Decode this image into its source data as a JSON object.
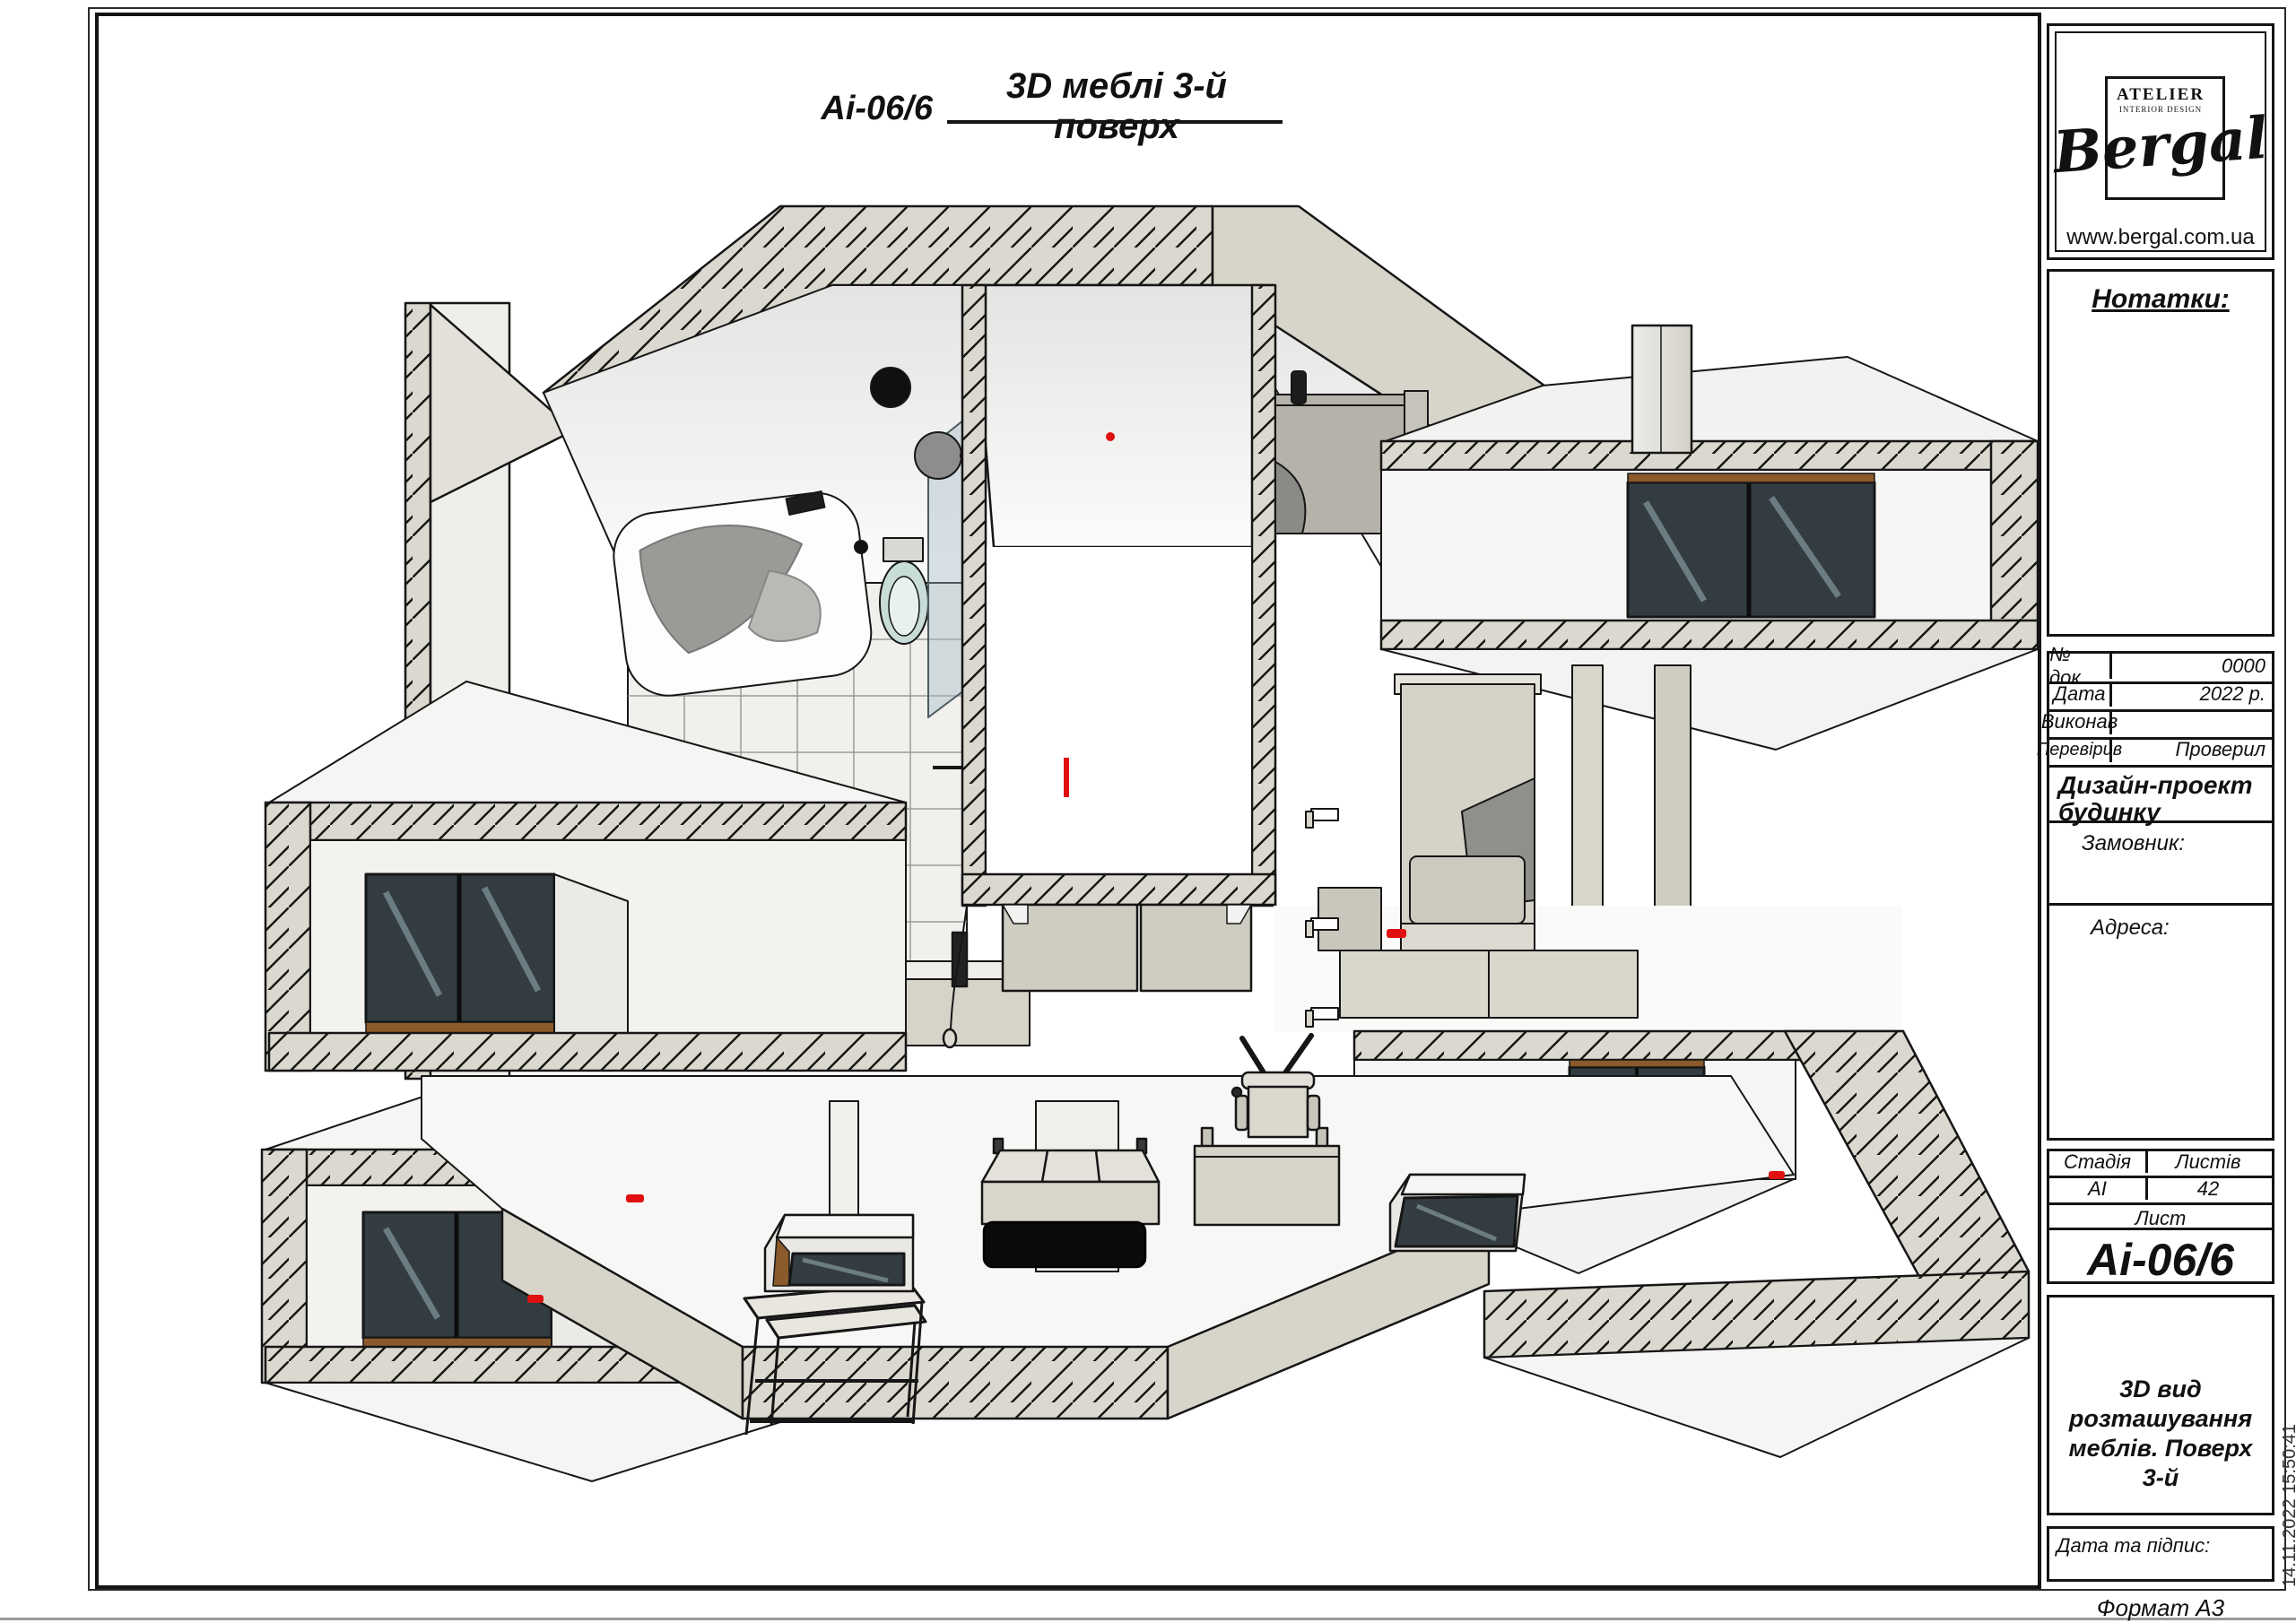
{
  "sheet": {
    "title_code": "Аі-06/6",
    "title": "3D меблі 3-й поверх",
    "format_label": "Формат А3",
    "timestamp": "14.11.2022 15:50:41"
  },
  "logo": {
    "atelier": "ATELIER",
    "subtitle": "INTERIOR DESIGN",
    "name": "Bergal",
    "website": "www.bergal.com.ua"
  },
  "notes": {
    "label": "Нотатки:"
  },
  "stamp": {
    "rows": [
      {
        "label": "№ док.",
        "value": "0000"
      },
      {
        "label": "Дата",
        "value": "2022 р."
      },
      {
        "label": "Виконав",
        "value": ""
      },
      {
        "label": "Перевірив",
        "value": "Проверил"
      }
    ],
    "project": "Дизайн-проект будинку",
    "customer_label": "Замовник:",
    "address_label": "Адреса:",
    "stage_label": "Стадія",
    "sheets_label": "Листів",
    "stage_value": "АІ",
    "sheets_value": "42",
    "sheet_label": "Лист",
    "sheet_value": "Аі-06/6",
    "description": "3D вид розташування меблів. Поверх 3-й",
    "date_sign_label": "Дата та підпис:"
  },
  "drawing": {
    "label": "3D cutaway axonometric view of 3rd floor furniture layout",
    "colors": {
      "hatch_fill": "#dbd8cf",
      "line": "#161616",
      "accent_red": "#e01010",
      "glass_dark": "#333c41",
      "glass_light": "#6b7c83",
      "wood": "#8a5a2b",
      "face_beige": "#d7d4ca",
      "face_light": "#efeeea"
    }
  }
}
